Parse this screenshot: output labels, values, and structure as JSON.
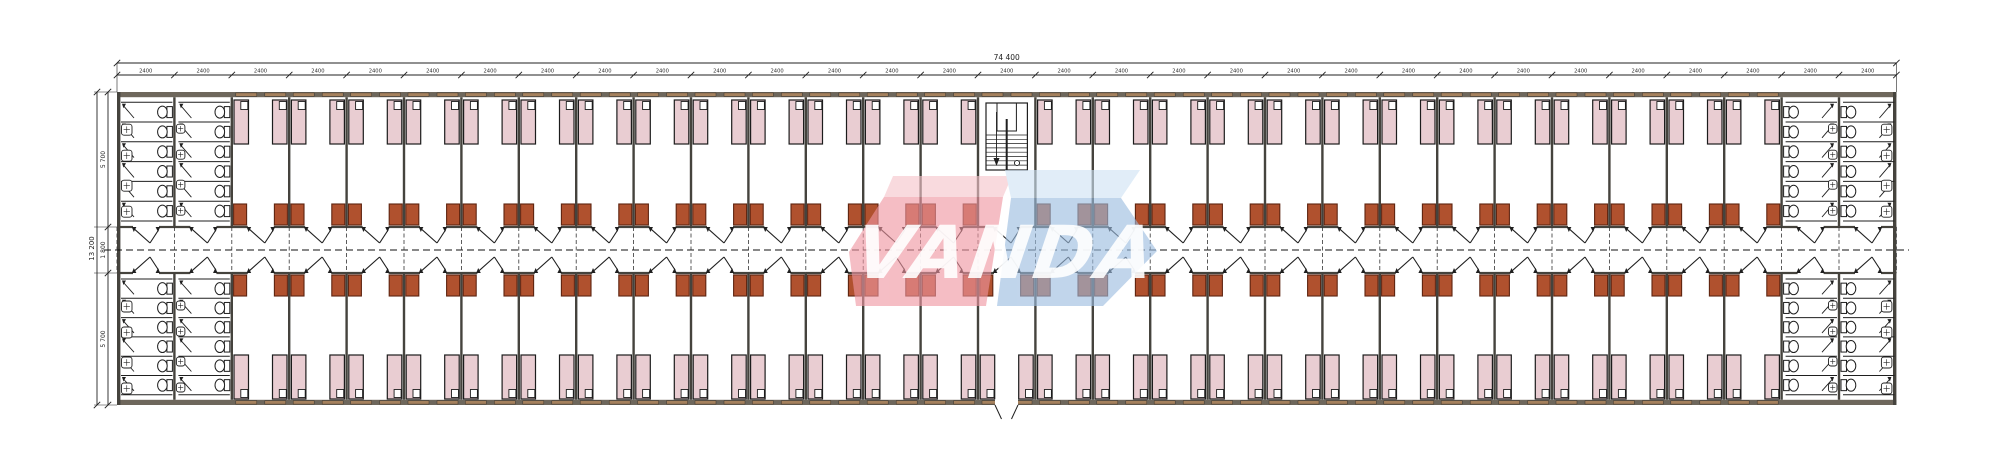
{
  "drawing": {
    "type": "architectural floor plan",
    "description": "Long dormitory block, double-loaded central corridor, repeated twin-bed rooms, sanitary blocks at both ends, central staircase, bottom-center entrance"
  },
  "watermark": {
    "text": "VANDA"
  },
  "dimensions": {
    "overall_width_label": "74 400",
    "bay_width_label": "2400",
    "bay_count": 31,
    "overall_height_label": "13 200",
    "upper_depth_label": "5 700",
    "corridor_width_label": "1 800",
    "lower_depth_label": "5 700"
  },
  "layout": {
    "bathroom_bays_per_end": 2,
    "stair_bay_position": "center bay, top row",
    "entrance_position": "bottom wall, center bay",
    "rooms_top_row": 26,
    "rooms_bottom_row": 27,
    "beds_per_room": 2,
    "wardrobes_per_room": 2,
    "bathroom_columns_per_block": 2,
    "toilet_stalls_per_column": 6,
    "sinks_per_bathroom_block": 8,
    "corridor_centerline_style": "dashed"
  },
  "colors": {
    "wall": "#45433d",
    "wall_fill": "#6e675c",
    "window": "#a5815d",
    "bed_fill": "#e9cdd2",
    "bed_stroke": "#1c1c1c",
    "pillow": "#ffffff",
    "wardrobe_fill": "#b0512e",
    "wardrobe_stroke": "#5e2410",
    "line": "#1f1f1f",
    "dim": "#222222",
    "wm_pink": "#ef96a1",
    "wm_pink_top": "#f6c5cb",
    "wm_blue": "#9bbcdf",
    "wm_blue_top": "#cfe3f4",
    "wm_text": "#ffffff"
  }
}
